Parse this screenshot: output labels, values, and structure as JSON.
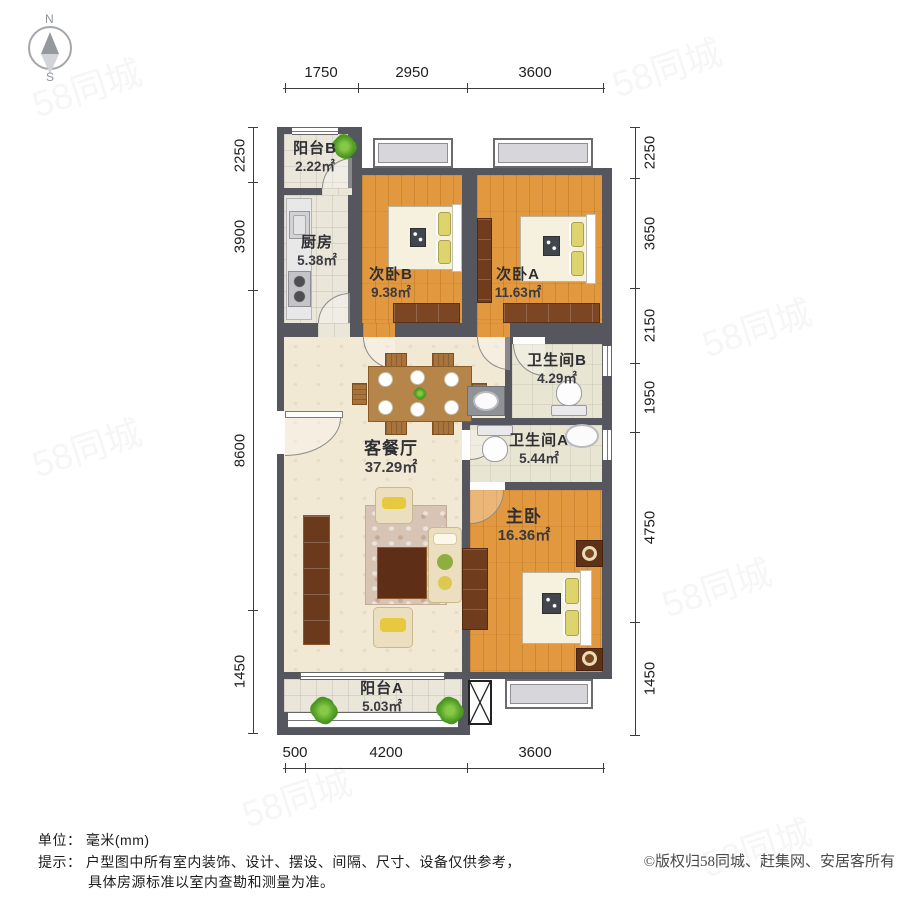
{
  "meta": {
    "watermark": "58同城",
    "unit_label": "单位：",
    "unit_value": "毫米(mm)",
    "tip_label": "提示：",
    "tip_line1": "户型图中所有室内装饰、设计、摆设、间隔、尺寸、设备仅供参考，",
    "tip_line2": "具体房源标准以室内查勘和测量为准。",
    "copyright": "©版权归58同城、赶集网、安居客所有"
  },
  "compass": {
    "north": "N",
    "south": "S"
  },
  "rooms": [
    {
      "id": "balcony_b",
      "name": "阳台B",
      "area": "2.22㎡"
    },
    {
      "id": "kitchen",
      "name": "厨房",
      "area": "5.38㎡"
    },
    {
      "id": "bedroom_b",
      "name": "次卧B",
      "area": "9.38㎡"
    },
    {
      "id": "bedroom_a",
      "name": "次卧A",
      "area": "11.63㎡"
    },
    {
      "id": "bath_b",
      "name": "卫生间B",
      "area": "4.29㎡"
    },
    {
      "id": "bath_a",
      "name": "卫生间A",
      "area": "5.44㎡"
    },
    {
      "id": "living",
      "name": "客餐厅",
      "area": "37.29㎡"
    },
    {
      "id": "master",
      "name": "主卧",
      "area": "16.36㎡"
    },
    {
      "id": "balcony_a",
      "name": "阳台A",
      "area": "5.03㎡"
    }
  ],
  "dimensions": {
    "unit": "mm",
    "top": [
      "1750",
      "2950",
      "3600"
    ],
    "bottom": [
      "500",
      "4200",
      "3600"
    ],
    "left": [
      "2250",
      "3900",
      "8600",
      "1450"
    ],
    "right": [
      "2250",
      "3650",
      "2150",
      "1950",
      "4750",
      "1450"
    ]
  },
  "palette": {
    "wall": "#56565e",
    "wood_floor": "#e2983f",
    "tile_floor": "#eae6da",
    "living_floor": "#f2e9d5",
    "closet_brown": "#7c4524",
    "plant_green": "#47951f",
    "dim_text": "#1f1f1f"
  }
}
